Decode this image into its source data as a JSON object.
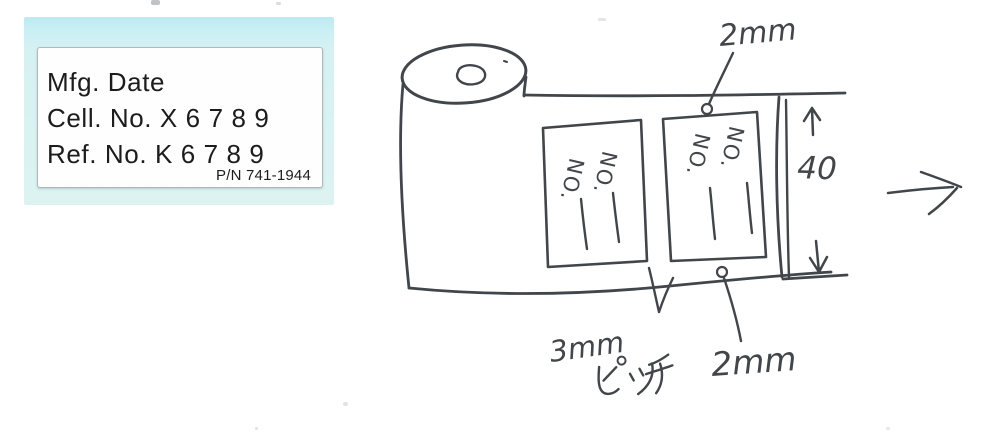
{
  "scan": {
    "background": "#ffffff"
  },
  "mfg_label": {
    "backing_color": "#cdeef4",
    "paper_color": "#fefefe",
    "text_color": "#1c1c1c",
    "lines": {
      "mfg_date": "Mfg. Date",
      "cell_no": "Cell. No. X 6 7 8 9",
      "ref_no": "Ref. No. K 6 7 8 9"
    },
    "part_number": "P/N 741-1944"
  },
  "sketch": {
    "ink_color": "#41464b",
    "label_field_text": "NO.",
    "annotations": {
      "top_margin": "2mm",
      "tape_width": "40",
      "pitch_value": "3mm",
      "pitch_unit": "ピッチ",
      "bottom_margin": "2mm"
    }
  }
}
